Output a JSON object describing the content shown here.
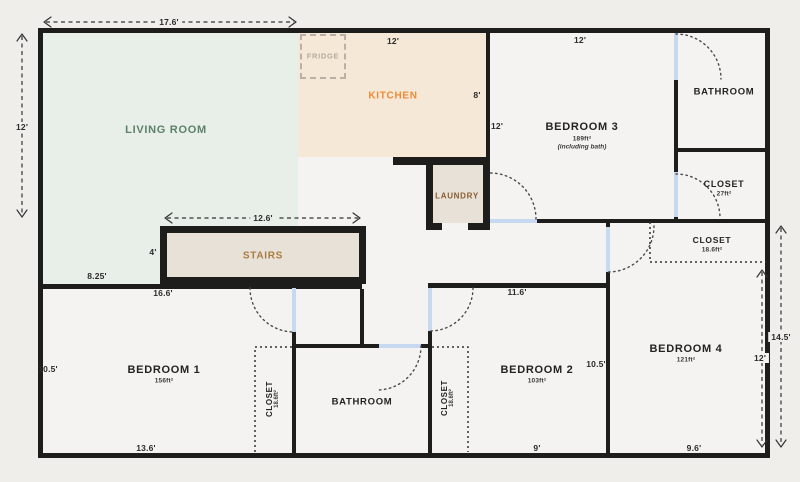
{
  "rooms": {
    "living": {
      "label": "LIVING ROOM"
    },
    "kitchen": {
      "label": "KITCHEN"
    },
    "fridge": {
      "label": "FRIDGE"
    },
    "laundry": {
      "label": "LAUNDRY"
    },
    "stairs": {
      "label": "STAIRS"
    },
    "bedroom3": {
      "label": "BEDROOM 3",
      "area": "189ft²",
      "note": "(including bath)"
    },
    "bathroom_top": {
      "label": "BATHROOM"
    },
    "closet_top": {
      "label": "CLOSET",
      "area": "27ft²"
    },
    "closet_hall": {
      "label": "CLOSET",
      "area": "18.6ft²"
    },
    "bedroom4": {
      "label": "BEDROOM 4",
      "area": "121ft²"
    },
    "bedroom1": {
      "label": "BEDROOM 1",
      "area": "156ft²"
    },
    "closet1": {
      "label": "CLOSET",
      "area": "18.6ft²"
    },
    "bathroom_bottom": {
      "label": "BATHROOM"
    },
    "closet2": {
      "label": "CLOSET",
      "area": "18.6ft²"
    },
    "bedroom2": {
      "label": "BEDROOM 2",
      "area": "103ft²"
    }
  },
  "dimensions": {
    "top_width": "17.6'",
    "living_height": "12'",
    "stairs_width": "12.6'",
    "stairs_height": "4'",
    "living_bottom": "8.25'",
    "bedroom1_top": "16.6'",
    "bedroom1_left": "10.5'",
    "bedroom1_bottom": "13.6'",
    "kitchen_top": "12'",
    "kitchen_right": "8'",
    "bedroom3_left": "12'",
    "bedroom3_top": "12'",
    "bedroom2_top": "11.6'",
    "bedroom2_right": "10.5'",
    "bedroom2_bottom": "9'",
    "bedroom4_bottom": "9.6'",
    "bedroom4_height": "12'",
    "right_height": "14.5'"
  },
  "colors": {
    "background": "#f0eeeb",
    "interior": "#f4f3f1",
    "living_fill": "#e7efe8",
    "kitchen_fill": "#f6e8d6",
    "stairs_laundry_fill": "#e7e1d8",
    "wall": "#1d1d1b",
    "door": "#c6d9f1",
    "living_text": "#5d8168",
    "kitchen_text": "#f08a35",
    "laundry_text": "#8a5c30",
    "stairs_text": "#aa7b3e",
    "fridge_text": "#b2aba3",
    "dim_text": "#2b2b2b"
  }
}
